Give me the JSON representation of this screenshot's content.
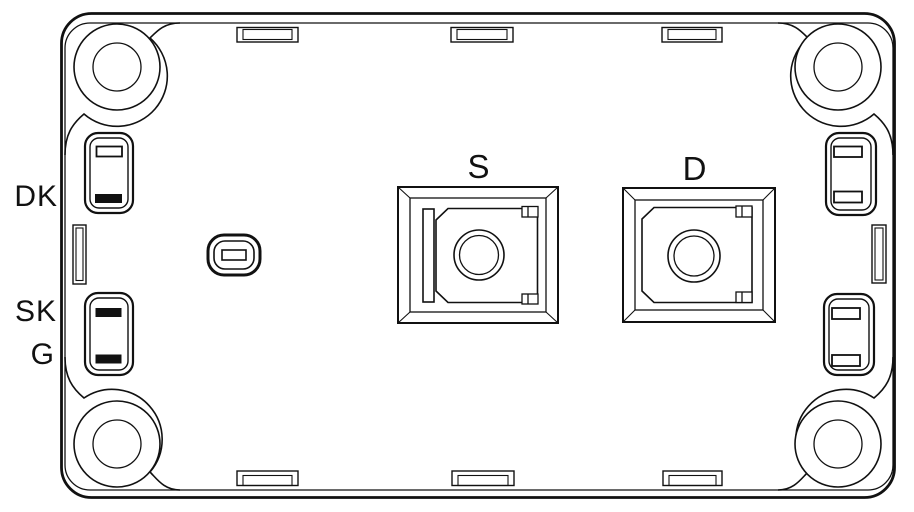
{
  "diagram": {
    "type": "technical-drawing",
    "description": "Top view outline drawing of a screw-terminal power semiconductor module with four corner mounting holes, two central power pads and auxiliary signal pins",
    "labels": {
      "aux_top_left": "DK",
      "aux_mid_left": "SK",
      "aux_bottom_left": "G",
      "pad_left": "S",
      "pad_right": "D"
    },
    "colors": {
      "ink": "#111111",
      "background": "#ffffff"
    }
  }
}
